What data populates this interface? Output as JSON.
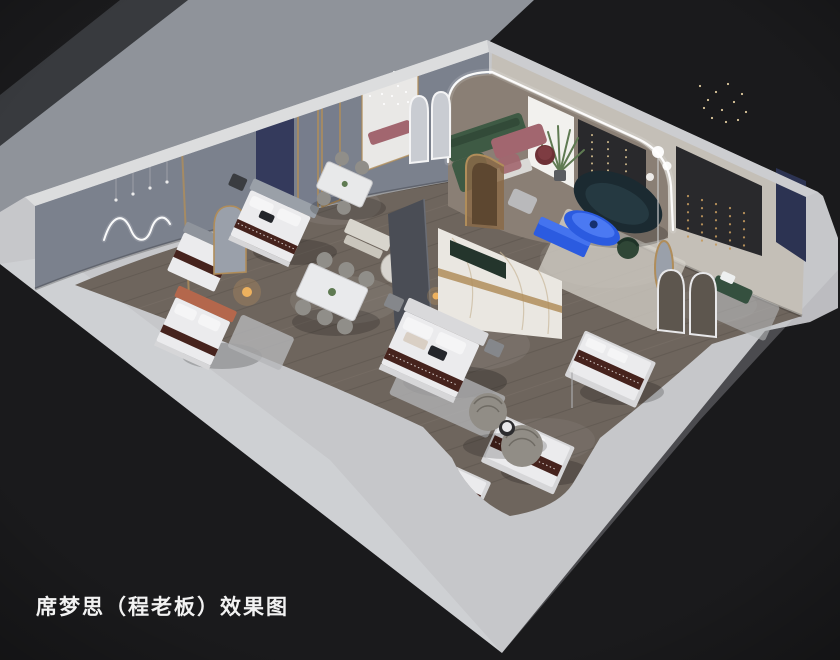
{
  "caption": {
    "text": "席梦思（程老板）效果图"
  },
  "colors": {
    "backdrop": "#1a1a1c",
    "ground_band": "#8f939a",
    "ground_shade": "#73777f",
    "slab": "#c6c7ca",
    "slab_bright": "#d6d7da",
    "wall_top": "#dcddde",
    "wall_top_right": "#cccdd0",
    "wall_left_face": "#8d93a1",
    "wall_right_face": "#c4bfb7",
    "alcove_floor": "#8a7f75",
    "panel_white": "#f2f1ee",
    "panel_dark": "#29292c",
    "panel_navy": "#2c3352",
    "navy_drape": "#343a5c",
    "floor_wood": "#6e655d",
    "plank": "#4f4841",
    "plank_light": "#978c80",
    "rug_gray": "#b5b7b9",
    "rug_cream": "#d5d2c9",
    "marble": "#eae7e1",
    "marble_vein": "#c9b89a",
    "gold": "#b08d5a",
    "slate": "#4a4d55",
    "mattress": "#ebebed",
    "platform": "#d6d6d8",
    "runner_brown": "#46231d",
    "headboard_gray": "#9aa0a8",
    "headboard_light": "#d9d9db",
    "headboard_orange": "#b4674c",
    "pillow": "#f5f5f6",
    "pillow_dark": "#24262b",
    "nightstand": "#85878b",
    "nightstand_dark": "#3a3c40",
    "sofa_green": "#3e5a44",
    "sofa_green_dark": "#2f4636",
    "sofa_teal": "#1b2a31",
    "sofa_teal_inner": "#253941",
    "cobalt": "#2b5be0",
    "cobalt_light": "#4b79f2",
    "mauve": "#a2666f",
    "wine": "#6e3136",
    "chair_gray": "#908e89",
    "rattan": "#918d86",
    "bench_green": "#35503f",
    "plant": "#5f7a52",
    "led": "#ffffff",
    "lamp_warm": "#f2b45e",
    "mirror_glass": "#9aa0aa",
    "doorway_light": "#e9e8e6",
    "caption_color": "#f2f2f2"
  }
}
